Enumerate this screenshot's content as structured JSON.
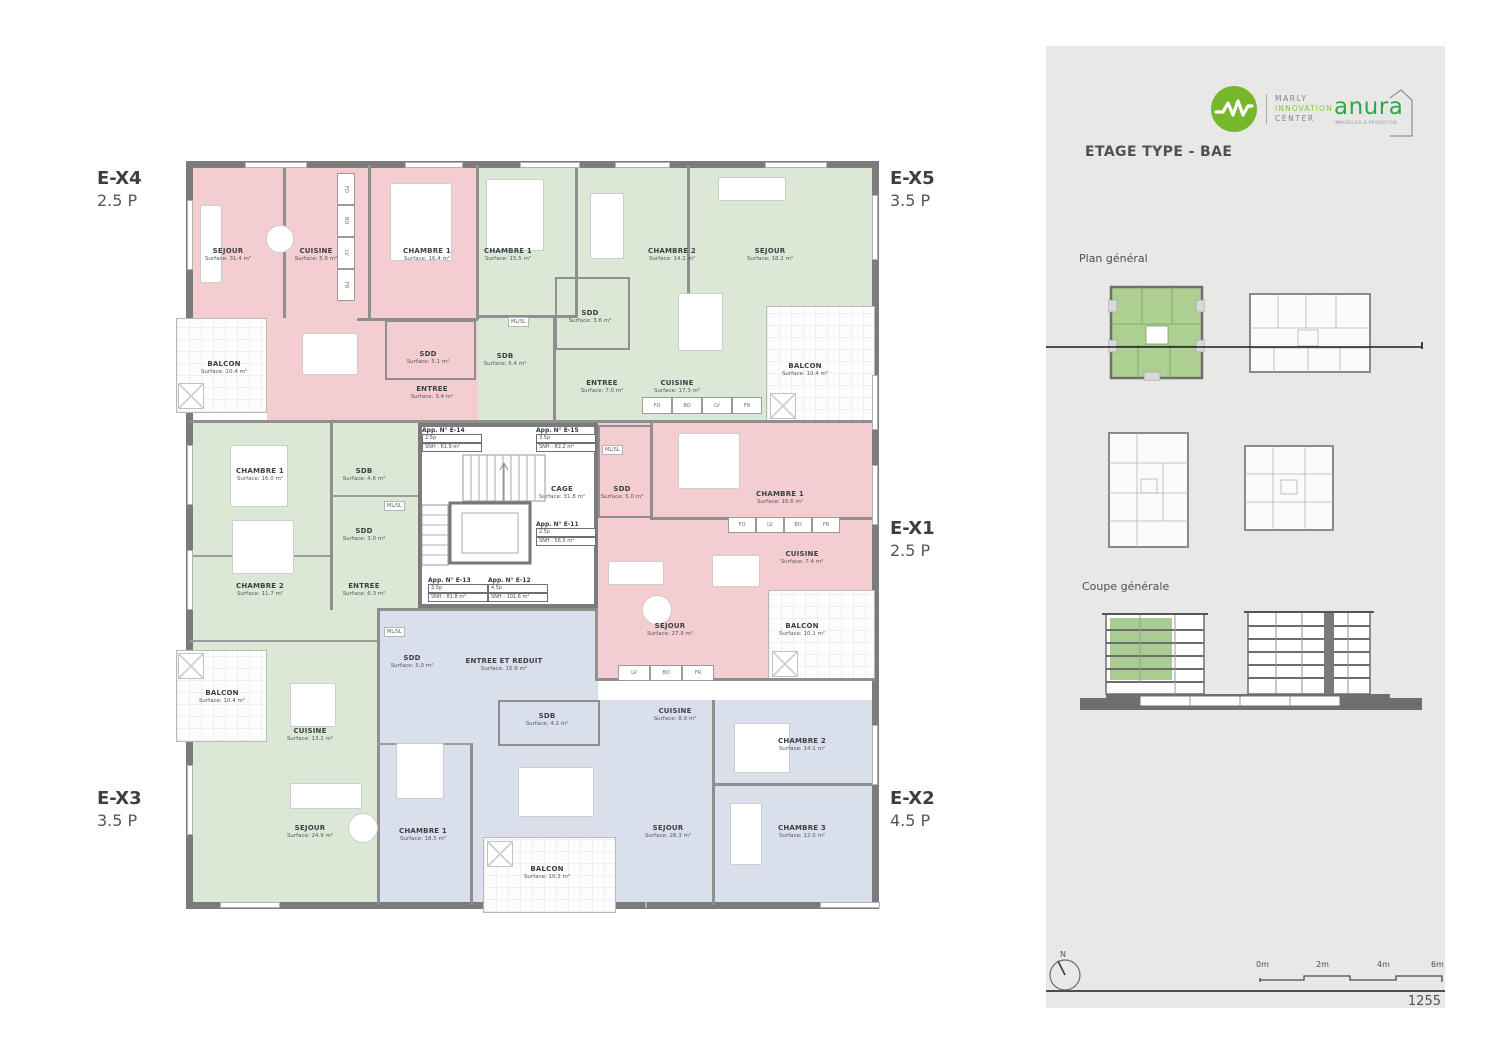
{
  "plan": {
    "units": [
      {
        "id": "E-X4",
        "pieces": "2.5 P"
      },
      {
        "id": "E-X5",
        "pieces": "3.5 P"
      },
      {
        "id": "E-X1",
        "pieces": "2.5 P"
      },
      {
        "id": "E-X3",
        "pieces": "3.5 P"
      },
      {
        "id": "E-X2",
        "pieces": "4.5 P"
      }
    ],
    "apartments": [
      {
        "id": "E-X4",
        "color": "#f4cdd0",
        "rooms": [
          {
            "name": "SEJOUR",
            "surface": "Surface: 31.4 m²"
          },
          {
            "name": "CUISINE",
            "surface": "Surface: 5.6 m²"
          },
          {
            "name": "CHAMBRE 1",
            "surface": "Surface: 16.4 m²"
          },
          {
            "name": "SDD",
            "surface": "Surface: 5.1 m²"
          },
          {
            "name": "ENTREE",
            "surface": "Surface: 3.4 m²"
          },
          {
            "name": "BALCON",
            "surface": "Surface: 10.4 m²"
          }
        ]
      },
      {
        "id": "E-X5",
        "color": "#dbe8d6",
        "rooms": [
          {
            "name": "CHAMBRE 1",
            "surface": "Surface: 15.5 m²"
          },
          {
            "name": "CHAMBRE 2",
            "surface": "Surface: 14.2 m²"
          },
          {
            "name": "SEJOUR",
            "surface": "Surface: 18.2 m²"
          },
          {
            "name": "SDD",
            "surface": "Surface: 3.6 m²"
          },
          {
            "name": "SDB",
            "surface": "Surface: 5.4 m²"
          },
          {
            "name": "ENTREE",
            "surface": "Surface: 7.0 m²"
          },
          {
            "name": "CUISINE",
            "surface": "Surface: 17.3 m²"
          },
          {
            "name": "BALCON",
            "surface": "Surface: 10.4 m²"
          }
        ]
      },
      {
        "id": "E-X1",
        "color": "#f4cdd0",
        "rooms": [
          {
            "name": "SDD",
            "surface": "Surface: 5.0 m²"
          },
          {
            "name": "CHAMBRE 1",
            "surface": "Surface: 16.6 m²"
          },
          {
            "name": "CUISINE",
            "surface": "Surface: 7.4 m²"
          },
          {
            "name": "SEJOUR",
            "surface": "Surface: 27.9 m²"
          },
          {
            "name": "BALCON",
            "surface": "Surface: 10.1 m²"
          }
        ]
      },
      {
        "id": "E-X2",
        "color": "#d9e0ec",
        "rooms": [
          {
            "name": "SDD",
            "surface": "Surface: 5.0 m²"
          },
          {
            "name": "ENTREE ET REDUIT",
            "surface": "Surface: 15.6 m²"
          },
          {
            "name": "SDB",
            "surface": "Surface: 4.2 m²"
          },
          {
            "name": "CUISINE",
            "surface": "Surface: 8.9 m²"
          },
          {
            "name": "CHAMBRE 1",
            "surface": "Surface: 18.5 m²"
          },
          {
            "name": "SEJOUR",
            "surface": "Surface: 28.3 m²"
          },
          {
            "name": "CHAMBRE 2",
            "surface": "Surface: 14.1 m²"
          },
          {
            "name": "CHAMBRE 3",
            "surface": "Surface: 12.0 m²"
          },
          {
            "name": "BALCON",
            "surface": "Surface: 10.3 m²"
          }
        ]
      },
      {
        "id": "E-X3",
        "color": "#dbe8d6",
        "rooms": [
          {
            "name": "CHAMBRE 1",
            "surface": "Surface: 16.0 m²"
          },
          {
            "name": "SDB",
            "surface": "Surface: 4.6 m²"
          },
          {
            "name": "SDD",
            "surface": "Surface: 3.0 m²"
          },
          {
            "name": "CHAMBRE 2",
            "surface": "Surface: 11.7 m²"
          },
          {
            "name": "ENTREE",
            "surface": "Surface: 6.3 m²"
          },
          {
            "name": "CUISINE",
            "surface": "Surface: 13.2 m²"
          },
          {
            "name": "SEJOUR",
            "surface": "Surface: 24.9 m²"
          },
          {
            "name": "BALCON",
            "surface": "Surface: 10.4 m²"
          }
        ]
      }
    ],
    "core": {
      "cage_name": "CAGE",
      "cage_surface": "Surface: 31.8 m²",
      "apps": [
        {
          "title": "App. N° E-14",
          "type": "2.5p",
          "snh": "SNH : 61.9 m²"
        },
        {
          "title": "App. N° E-15",
          "type": "3.5p",
          "snh": "SNH : 82.2 m²"
        },
        {
          "title": "App. N° E-11",
          "type": "2.5p",
          "snh": "SNH : 56.5 m²"
        },
        {
          "title": "App. N° E-13",
          "type": "3.5p",
          "snh": "SNH : 81.8 m²"
        },
        {
          "title": "App. N° E-12",
          "type": "4.5p",
          "snh": "SNH : 101.6 m²"
        }
      ]
    },
    "mlsl": "ML/SL",
    "strips": {
      "ex4": [
        "FO",
        "BO",
        "LV",
        "FR"
      ],
      "ex5": [
        "FO",
        "BO",
        "LV",
        "FR"
      ],
      "ex1": [
        "FO",
        "LV",
        "BO",
        "FR"
      ],
      "ex2": [
        "LV",
        "BO",
        "FR"
      ]
    }
  },
  "sidebar": {
    "mic_logo": {
      "line1": "MARLY",
      "line2": "INNOVATION",
      "line3": "CENTER"
    },
    "anura_logo": {
      "name": "anura",
      "tagline": "IMMOBILIER & PROMOTION"
    },
    "title": "ETAGE TYPE - BAE",
    "plan_general_label": "Plan général",
    "coupe_label": "Coupe générale",
    "north_label": "N",
    "scale_labels": [
      "0m",
      "2m",
      "4m",
      "6m"
    ],
    "page_number": "1255"
  }
}
